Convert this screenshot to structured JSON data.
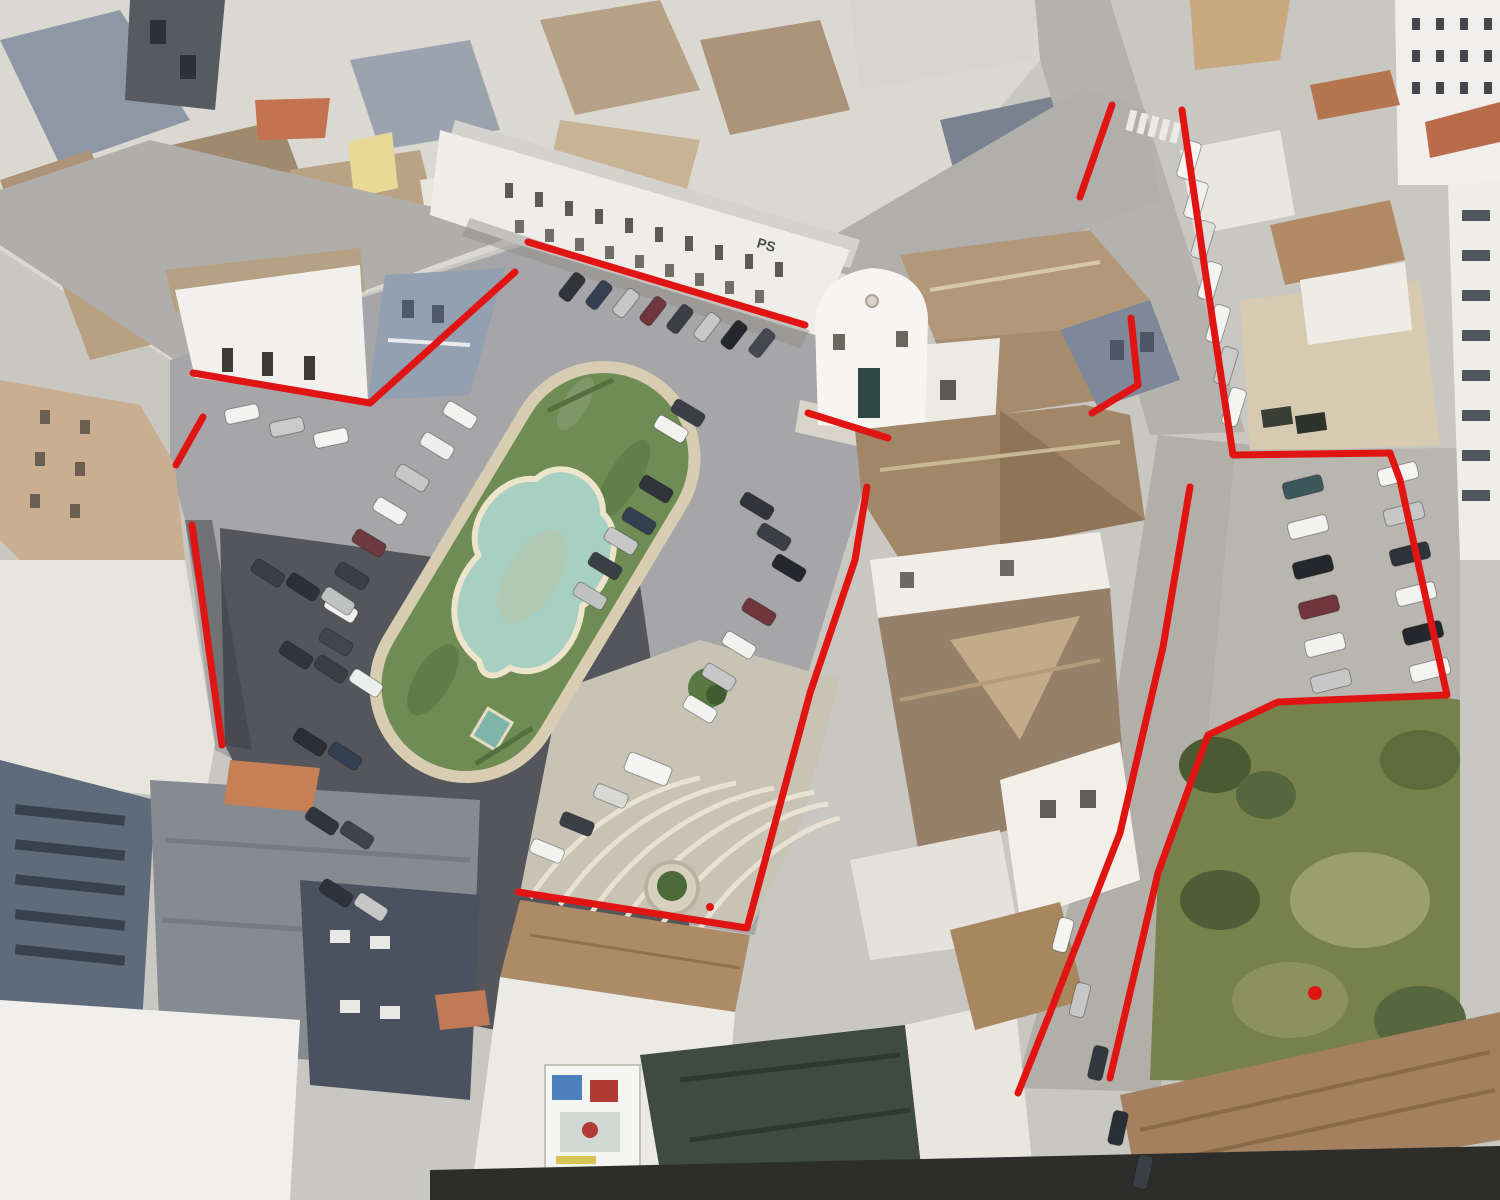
{
  "scene": {
    "description": "Oblique aerial view of a town square with an oval garden island and organic-shaped fountain pool, surrounded by parked cars, old tiled-roof buildings, a white church, streets and a green vacant lot; a red boundary is drawn around the block",
    "signs": [
      {
        "text": "PS"
      }
    ],
    "colors": {
      "annotation_red": "#e11414",
      "grass": "#6f8c55",
      "pool_water": "#a7cfc2",
      "pool_rim": "#ece4cb",
      "island_walk": "#d8cdb2",
      "asphalt": "#a6a6a8",
      "street": "#b3b1ac",
      "dark_parking": "#54565b",
      "roof_terracotta": "#b5754e",
      "roof_tan": "#ab947a",
      "vacant_lot_green": "#77814c",
      "tarp_green": "#3e4a42"
    },
    "cars": [
      [
        460,
        415,
        31,
        "#f2f2f0"
      ],
      [
        437,
        446,
        31,
        "#eceded"
      ],
      [
        412,
        478,
        31,
        "#c6c7c6"
      ],
      [
        390,
        511,
        31,
        "#f2f2f0"
      ],
      [
        369,
        543,
        31,
        "#6e3a40"
      ],
      [
        352,
        576,
        31,
        "#3a3e45"
      ],
      [
        341,
        609,
        31,
        "#f0f0ee"
      ],
      [
        336,
        642,
        31,
        "#41454c"
      ],
      [
        688,
        413,
        31,
        "#3a3e45"
      ],
      [
        671,
        429,
        31,
        "#f2f2f0"
      ],
      [
        656,
        489,
        31,
        "#30343b"
      ],
      [
        639,
        521,
        31,
        "#353f52"
      ],
      [
        621,
        541,
        31,
        "#c6c7c6"
      ],
      [
        605,
        566,
        31,
        "#3a3e45"
      ],
      [
        590,
        596,
        31,
        "#c0c1c1"
      ],
      [
        757,
        506,
        31,
        "#2f333a"
      ],
      [
        774,
        537,
        31,
        "#3a3e45"
      ],
      [
        789,
        568,
        31,
        "#24272b"
      ],
      [
        759,
        612,
        31,
        "#70363c"
      ],
      [
        739,
        645,
        31,
        "#f1f1ef"
      ],
      [
        719,
        677,
        31,
        "#c6c7c6"
      ],
      [
        700,
        709,
        31,
        "#f2f2f0"
      ],
      [
        648,
        769,
        22,
        "#f4f4f2",
        46,
        20
      ],
      [
        611,
        796,
        22,
        "#d8d8d6"
      ],
      [
        577,
        824,
        22,
        "#3a3e45"
      ],
      [
        547,
        851,
        22,
        "#f2f2f0"
      ],
      [
        572,
        287,
        -52,
        "#30343b",
        30,
        14
      ],
      [
        599,
        295,
        -52,
        "#353f52",
        30,
        14
      ],
      [
        626,
        303,
        -52,
        "#c6c7c6",
        30,
        14
      ],
      [
        653,
        311,
        -52,
        "#70363c",
        30,
        14
      ],
      [
        680,
        319,
        -52,
        "#3a3e45",
        30,
        14
      ],
      [
        707,
        327,
        -52,
        "#c6c7c6",
        30,
        14
      ],
      [
        734,
        335,
        -52,
        "#24272b",
        30,
        14
      ],
      [
        762,
        343,
        -52,
        "#45494f",
        30,
        14
      ],
      [
        242,
        414,
        -12,
        "#f2f2f0"
      ],
      [
        287,
        427,
        -12,
        "#c9cac9"
      ],
      [
        331,
        438,
        -12,
        "#f4f4f2"
      ],
      [
        268,
        573,
        33,
        "#3a3e45"
      ],
      [
        303,
        587,
        33,
        "#2c3038"
      ],
      [
        338,
        601,
        33,
        "#c0c1c1"
      ],
      [
        296,
        655,
        33,
        "#30343b"
      ],
      [
        331,
        669,
        33,
        "#3a3e45"
      ],
      [
        366,
        683,
        33,
        "#eceded"
      ],
      [
        310,
        742,
        33,
        "#2a2e35"
      ],
      [
        345,
        756,
        33,
        "#353f52"
      ],
      [
        322,
        821,
        33,
        "#30343b"
      ],
      [
        357,
        835,
        33,
        "#3f434a"
      ],
      [
        336,
        893,
        33,
        "#2e323a"
      ],
      [
        371,
        907,
        33,
        "#c6c7c6"
      ],
      [
        1189,
        160,
        -73,
        "#f4f4f2",
        38,
        16
      ],
      [
        1196,
        200,
        -73,
        "#f0f0ee",
        38,
        16
      ],
      [
        1203,
        240,
        -73,
        "#dededd",
        38,
        16
      ],
      [
        1210,
        281,
        -73,
        "#f4f4f2",
        38,
        16
      ],
      [
        1218,
        324,
        -73,
        "#f2f2f0",
        38,
        16
      ],
      [
        1226,
        366,
        -73,
        "#c9cac9",
        38,
        16
      ],
      [
        1234,
        407,
        -73,
        "#f4f4f2",
        38,
        16
      ],
      [
        1063,
        935,
        -75,
        "#f4f4f2"
      ],
      [
        1080,
        1000,
        -76,
        "#c6c7c6"
      ],
      [
        1098,
        1063,
        -77,
        "#33373e"
      ],
      [
        1118,
        1128,
        -78,
        "#2a2e35"
      ],
      [
        1143,
        1172,
        -78,
        "#3a3e45"
      ],
      [
        1303,
        487,
        -14,
        "#3d585c",
        40,
        17
      ],
      [
        1308,
        527,
        -14,
        "#f2f2f0",
        40,
        17
      ],
      [
        1313,
        567,
        -14,
        "#24272b",
        40,
        17
      ],
      [
        1319,
        607,
        -14,
        "#70363c",
        40,
        17
      ],
      [
        1325,
        645,
        -14,
        "#f2f2f0",
        40,
        17
      ],
      [
        1331,
        681,
        -14,
        "#c6c7c6",
        40,
        17
      ],
      [
        1398,
        474,
        -14,
        "#f4f4f2",
        40,
        17
      ],
      [
        1404,
        514,
        -14,
        "#c6c7c6",
        40,
        17
      ],
      [
        1410,
        554,
        -14,
        "#2e323a",
        40,
        17
      ],
      [
        1416,
        594,
        -14,
        "#f2f2f0",
        40,
        17
      ],
      [
        1423,
        633,
        -14,
        "#24272b",
        40,
        17
      ],
      [
        1430,
        670,
        -14,
        "#f4f4f2",
        40,
        17
      ]
    ]
  },
  "annotations": {
    "color": "#e11414",
    "stroke_width": 7,
    "segments": [
      {
        "name": "north-building-line",
        "points": [
          [
            193,
            373
          ],
          [
            370,
            403
          ],
          [
            515,
            272
          ]
        ]
      },
      {
        "name": "northeast-parking-line",
        "points": [
          [
            528,
            242
          ],
          [
            805,
            325
          ]
        ]
      },
      {
        "name": "west-corner-line",
        "points": [
          [
            176,
            465
          ],
          [
            203,
            417
          ]
        ]
      },
      {
        "name": "west-side-line",
        "points": [
          [
            192,
            525
          ],
          [
            222,
            745
          ]
        ]
      },
      {
        "name": "church-forecourt-line",
        "points": [
          [
            808,
            413
          ],
          [
            888,
            438
          ]
        ]
      },
      {
        "name": "southwest-boundary-line",
        "points": [
          [
            867,
            487
          ],
          [
            855,
            560
          ],
          [
            810,
            693
          ],
          [
            747,
            928
          ],
          [
            518,
            892
          ]
        ]
      },
      {
        "name": "north-street-left-line",
        "points": [
          [
            1112,
            105
          ],
          [
            1080,
            197
          ]
        ]
      },
      {
        "name": "east-boundary-line",
        "points": [
          [
            1182,
            110
          ],
          [
            1205,
            270
          ],
          [
            1233,
            455
          ],
          [
            1390,
            453
          ],
          [
            1400,
            480
          ],
          [
            1447,
            695
          ],
          [
            1278,
            702
          ],
          [
            1208,
            735
          ],
          [
            1158,
            873
          ],
          [
            1110,
            1078
          ]
        ]
      },
      {
        "name": "church-rear-line",
        "points": [
          [
            1131,
            318
          ],
          [
            1138,
            385
          ],
          [
            1092,
            413
          ]
        ]
      },
      {
        "name": "south-street-line",
        "points": [
          [
            1190,
            487
          ],
          [
            1163,
            647
          ],
          [
            1120,
            833
          ],
          [
            1050,
            1013
          ],
          [
            1018,
            1093
          ]
        ]
      }
    ],
    "dots": [
      {
        "name": "lot-marker-dot",
        "x": 1315,
        "y": 993,
        "r": 7
      },
      {
        "name": "walk-marker-dot",
        "x": 710,
        "y": 907,
        "r": 4
      }
    ]
  }
}
